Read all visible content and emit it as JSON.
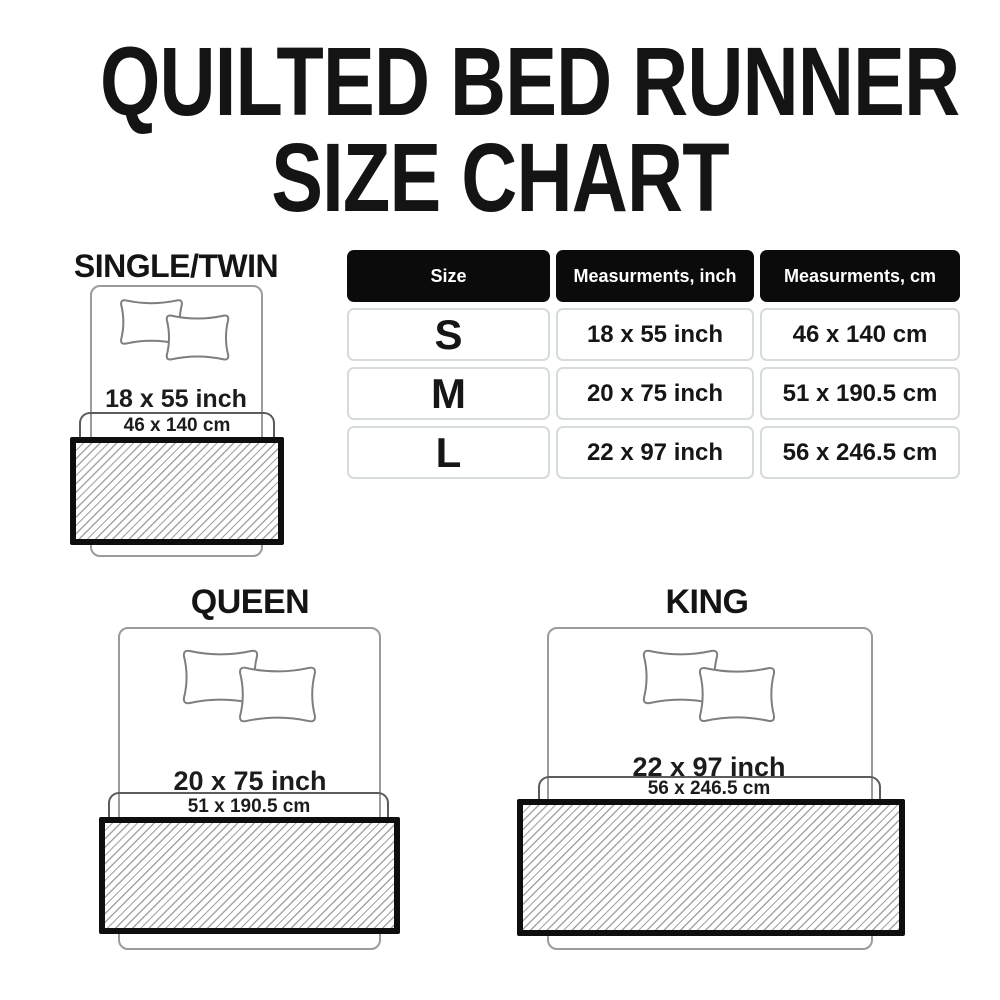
{
  "title": {
    "line1": "QUILTED BED RUNNER",
    "line2": "SIZE CHART"
  },
  "table": {
    "headers": [
      "Size",
      "Measurments, inch",
      "Measurments, cm"
    ],
    "rows": [
      {
        "size": "S",
        "inch": "18 x 55 inch",
        "cm": "46 x 140 cm"
      },
      {
        "size": "M",
        "inch": "20 x 75 inch",
        "cm": "51 x 190.5 cm"
      },
      {
        "size": "L",
        "inch": "22 x 97 inch",
        "cm": "56 x 246.5 cm"
      }
    ]
  },
  "chart_data": {
    "type": "table",
    "title": "Quilted Bed Runner Size Chart",
    "columns": [
      "Size",
      "Measurments, inch",
      "Measurments, cm"
    ],
    "rows": [
      [
        "S",
        "18 x 55 inch",
        "46 x 140 cm"
      ],
      [
        "M",
        "20 x 75 inch",
        "51 x 190.5 cm"
      ],
      [
        "L",
        "22 x 97 inch",
        "56 x 246.5 cm"
      ]
    ]
  },
  "diagrams": {
    "single": {
      "label": "SINGLE/TWIN",
      "inch": "18 x 55 inch",
      "cm": "46 x 140 cm"
    },
    "queen": {
      "label": "QUEEN",
      "inch": "20 x 75 inch",
      "cm": "51 x 190.5 cm"
    },
    "king": {
      "label": "KING",
      "inch": "22 x 97 inch",
      "cm": "56 x 246.5 cm"
    }
  },
  "colors": {
    "background": "#ffffff",
    "text": "#141414",
    "header_bg": "#0b0b0b",
    "header_text": "#ffffff",
    "cell_border": "#d6dcda",
    "bed_outline": "#9b9b9b",
    "pillow_outline": "#7e7e7e",
    "bracket": "#5c5c5c",
    "runner_border": "#0e0e0e",
    "hatch_line": "#a4a4a4"
  }
}
